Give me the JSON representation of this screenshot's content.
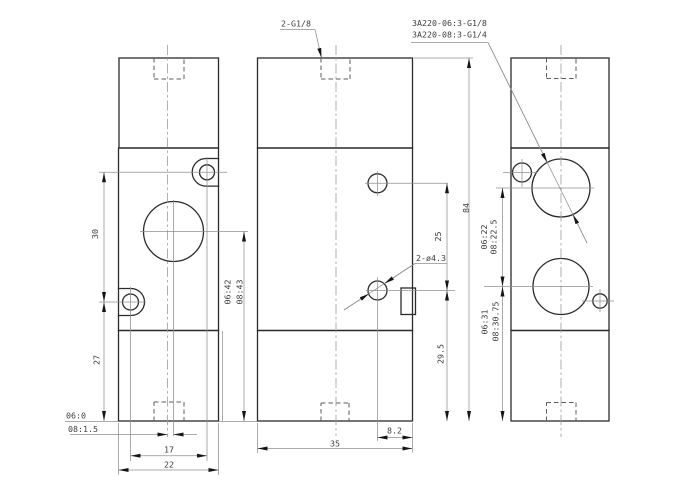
{
  "title_labels": {
    "model_1": "3A220-06:3-G1/8",
    "model_2": "3A220-08:3-G1/4",
    "top_port": "2-G1/8",
    "pilot_holes": "2-ø4.3"
  },
  "front_view": {
    "dim_upper_height": "30",
    "dim_lower_height": "27",
    "dim_hole_span": "17",
    "dim_width": "22",
    "offset_06": "06:0",
    "offset_08": "08:1.5",
    "center_height_06": "06:42",
    "center_height_08": "08:43"
  },
  "side_view": {
    "dim_hole_gap": "25",
    "dim_hole_bottom": "29.5",
    "dim_total_height": "84",
    "dim_hole_edge": "8.2",
    "dim_depth": "35"
  },
  "back_view": {
    "port_pitch_06": "06:22",
    "port_pitch_08": "08:22.5",
    "port_bottom_06": "06:31",
    "port_bottom_08": "08:30.75"
  },
  "colors": {
    "background": "#ffffff",
    "outline": "#2b2b2b",
    "dimension": "#8f8f8f",
    "text": "#3d3d3d"
  }
}
